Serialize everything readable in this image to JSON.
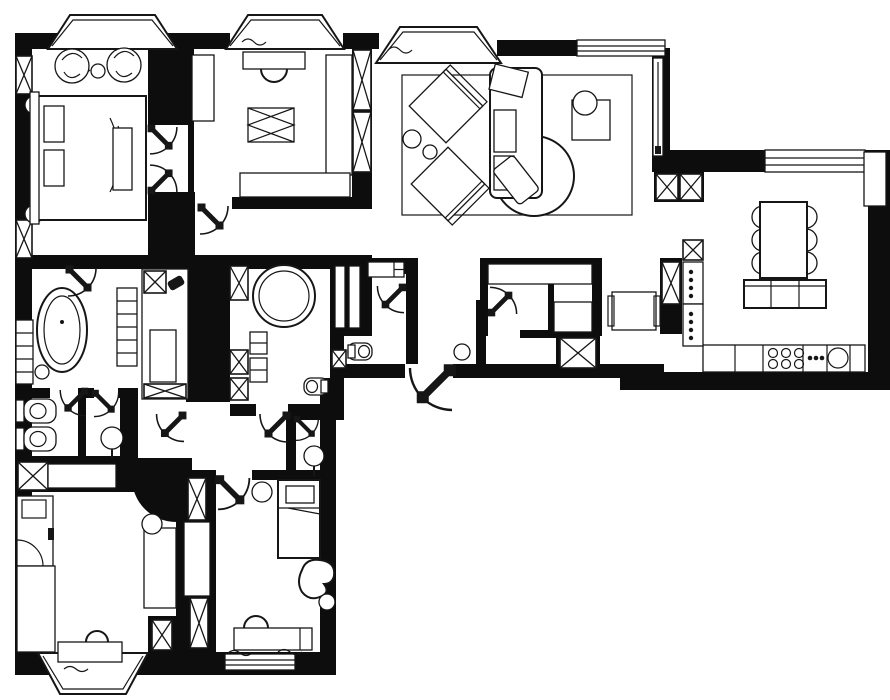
{
  "meta": {
    "kind": "residential apartment floor plan drawing",
    "style": "black and white architectural plan",
    "background_color": "#ffffff",
    "wall_color": "#0d0d0d",
    "line_color": "#161616"
  },
  "rooms": {
    "master_bedroom": "master bedroom with double bed, bench and two armchairs in bay window",
    "dressing_room": "dressing room with vanity desk, island and wardrobe rails",
    "living_room": "living room with rug, two armchairs, sofa, round coffee table and plant table",
    "kitchen_dining": "kitchen and dining room with six-seat table, sideboard, cooktop and sink counter",
    "master_bathroom": "bathroom with freestanding oval bathtub and shelving",
    "laundry_closet": "utility closet with washing machine",
    "shower_room": "shower room with round walk-in shower, cabinet and wall-hung toilet",
    "guest_wc": "guest wc with wall-hung toilet and shelf",
    "wc_bidet_room": "wc with wall-hung toilet and bidet",
    "washroom": "washroom with pedestal sink",
    "sink_niche": "corridor sink niche",
    "walk_in_closet": "walk-in closet with clothes rails",
    "hallway": "entrance hall with side table",
    "kids_room": "children's room with wardrobe cabinet, desk and window-seat console",
    "small_bedroom": "bedroom with single bed, stool, organic armchair and desk"
  },
  "symbols": {
    "bay_window": "bay-window",
    "window": "window",
    "vent_shaft": "ventilation-shaft-x-box",
    "wardrobe_rail": "hatched-wardrobe-rail",
    "soft_mat": "crosshatched-mat",
    "door": "door-swing-arc",
    "pocket_door": "sliding-pocket-door",
    "entrance_door": "entrance-door-swing",
    "double_bed": "double-bed",
    "single_bed": "single-bed",
    "bathtub": "freestanding-oval-bathtub",
    "round_shower": "round-walk-in-shower",
    "wall_hung_toilet": "wall-hung-toilet",
    "bidet": "wall-hung-bidet",
    "pedestal_sink": "pedestal-sink",
    "washing_machine": "washing-machine",
    "dining_table": "dining-table-six-chairs",
    "sideboard": "sideboard",
    "cooktop": "six-burner-cooktop",
    "kitchen_sink": "round-kitchen-sink",
    "tall_units": "tall-appliance-units",
    "sofa": "sofa-with-round-chaise",
    "armchair": "armchair",
    "coffee_table": "round-coffee-table",
    "plant_table": "plant-side-table",
    "rug": "area-rug",
    "desk": "desk",
    "chair": "chair",
    "stool": "stool",
    "island": "storage-island",
    "shelving": "shelving-unit",
    "side_table": "hall-side-table"
  }
}
